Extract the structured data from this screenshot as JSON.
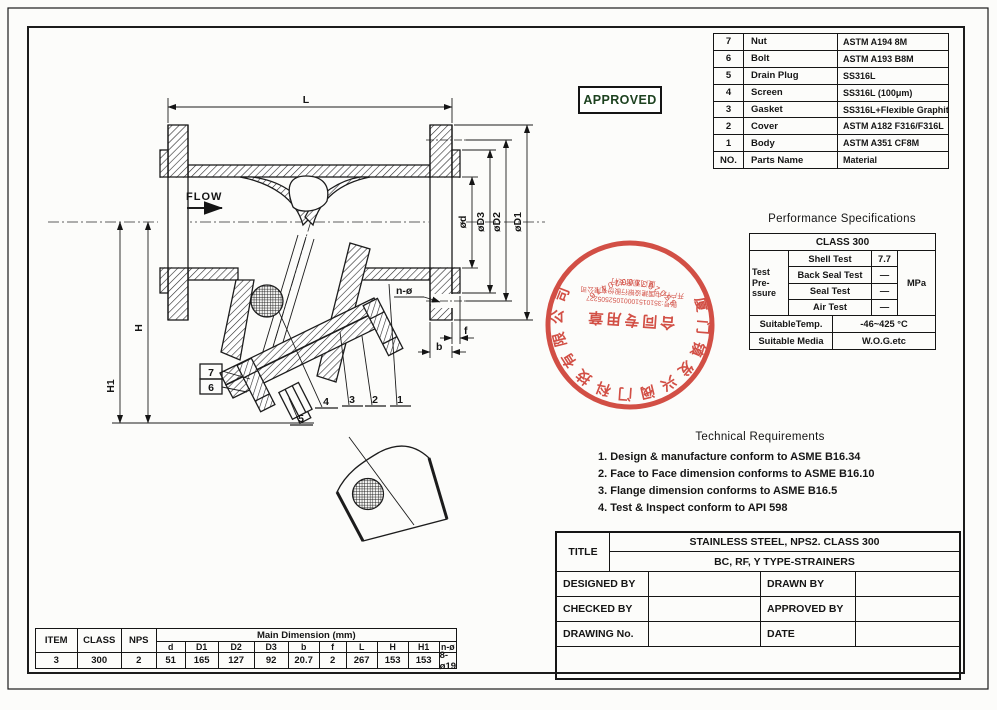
{
  "approved_label": "APPROVED",
  "parts_table": {
    "rows": [
      {
        "no": "7",
        "name": "Nut",
        "material": "ASTM A194 8M"
      },
      {
        "no": "6",
        "name": "Bolt",
        "material": "ASTM A193 B8M"
      },
      {
        "no": "5",
        "name": "Drain Plug",
        "material": "SS316L"
      },
      {
        "no": "4",
        "name": "Screen",
        "material": "SS316L (100μm)"
      },
      {
        "no": "3",
        "name": "Gasket",
        "material": "SS316L+Flexible Graphite"
      },
      {
        "no": "2",
        "name": "Cover",
        "material": "ASTM A182 F316/F316L"
      },
      {
        "no": "1",
        "name": "Body",
        "material": "ASTM A351 CF8M"
      },
      {
        "no": "NO.",
        "name": "Parts Name",
        "material": "Material"
      }
    ]
  },
  "performance": {
    "title": "Performance Specifications",
    "class_row": "CLASS 300",
    "group_l1": "Test",
    "group_l2": "Pre-",
    "group_l3": "ssure",
    "tests": [
      {
        "name": "Shell Test",
        "value": "7.7"
      },
      {
        "name": "Back Seal Test",
        "value": "—"
      },
      {
        "name": "Seal Test",
        "value": "—"
      },
      {
        "name": "Air Test",
        "value": "—"
      }
    ],
    "unit": "MPa",
    "temp_label": "SuitableTemp.",
    "temp_value": "-46~425 °C",
    "media_label": "Suitable Media",
    "media_value": "W.O.G.etc"
  },
  "technical_requirements": {
    "title": "Technical Requirements",
    "items": [
      "1.  Design & manufacture conform to ASME B16.34",
      "2.  Face to Face dimension conforms to ASME B16.10",
      "3.  Flange dimension conforms to ASME B16.5",
      "4.  Test & Inspect conform to API 598"
    ]
  },
  "title_block": {
    "title_label": "TITLE",
    "title_line1": "STAINLESS STEEL, NPS2. CLASS 300",
    "title_line2": "BC, RF, Y TYPE-STRAINERS",
    "designed_by": "DESIGNED BY",
    "drawn_by": "DRAWN BY",
    "checked_by": "CHECKED BY",
    "approved_by": "APPROVED BY",
    "drawing_no": "DRAWING No.",
    "date": "DATE"
  },
  "dimension_table": {
    "item_label": "ITEM",
    "class_label": "CLASS",
    "nps_label": "NPS",
    "main_header": "Main Dimension (mm)",
    "sub_headers": [
      "d",
      "D1",
      "D2",
      "D3",
      "b",
      "f",
      "L",
      "H",
      "H1",
      "n-ø"
    ],
    "item": "3",
    "class": "300",
    "nps": "2",
    "values": [
      "51",
      "165",
      "127",
      "92",
      "20.7",
      "2",
      "267",
      "153",
      "153",
      "8-ø19"
    ]
  },
  "drawing_labels": {
    "flow": "FLOW",
    "L": "L",
    "H": "H",
    "H1": "H1",
    "d": "ød",
    "D3": "øD3",
    "D2": "øD2",
    "D1": "øD1",
    "f": "f",
    "b": "b",
    "n": "n-ø",
    "callout_1": "1",
    "callout_2": "2",
    "callout_3": "3",
    "callout_4": "4",
    "callout_5": "5",
    "callout_6": "6",
    "callout_7": "7"
  },
  "seal": {
    "ring_text": "厦门镇发兴阀门科技有限公司",
    "center_text": "合同专用章",
    "account_line": "账号:35101510001052505227",
    "bank_line": "开户行:中国建设银行股份有限公司",
    "branch_line": "厦门观音支行",
    "serial": "35020310020476",
    "color": "#cf372c"
  }
}
